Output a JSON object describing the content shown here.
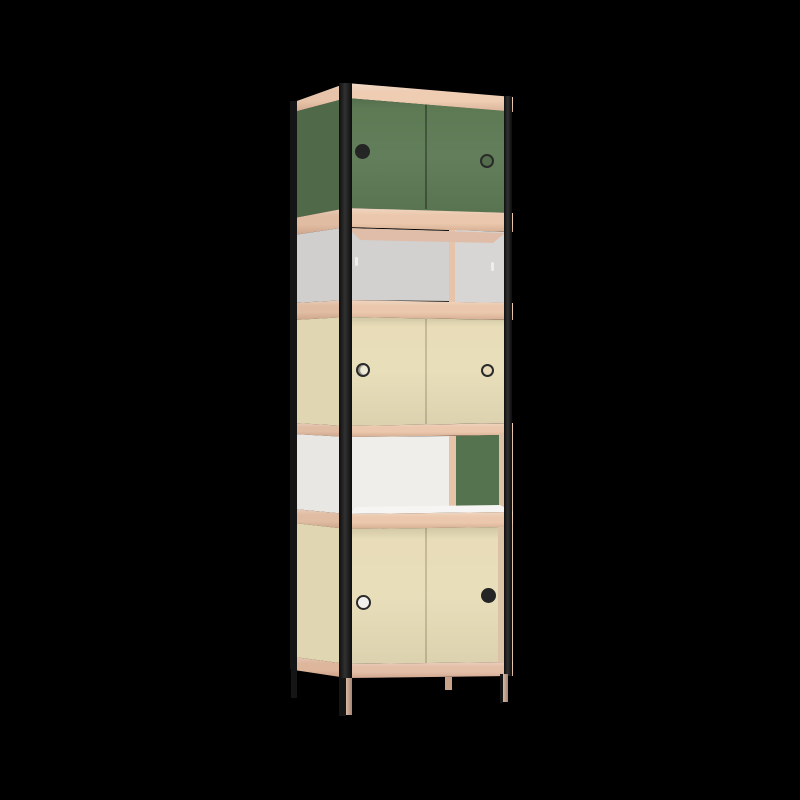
{
  "scene": {
    "background": "#000000",
    "subject": "3D product render of a five-tier modular shelving cabinet with plywood shelf edges, black frame posts and colored sliding doors"
  },
  "colors": {
    "ply_light": "#eecdb3",
    "ply_front": "#ebc8ad",
    "ply_side": "#e0bca2",
    "ply_side_top": "#e6c3a9",
    "ply_base": "#e4bfa8",
    "ply_side_base": "#ddb69c",
    "ply_ceiling": "#dfbda8",
    "ply_strip": "#e7c4a9",
    "ply_edge": "#dcc3a7",
    "green_front": "#5d7a55",
    "green_side": "#506949",
    "green_panel": "#55734e",
    "green_hole": "#4f6a48",
    "beige_front": "#e8ddb8",
    "beige_side": "#e1d6b2",
    "beige_hole": "#e5dab4",
    "beige_hole_bright": "#efe9d6",
    "gray_door_left": "#d2d1cf",
    "gray_door_right": "#d7d6d4",
    "gray_side": "#d0cfcd",
    "white_back": "#f0eeeb",
    "white_floor": "#f6f5f3",
    "white_side": "#e9e7e4",
    "hole_white": "#f3f1ee",
    "handle_light": "#eeedeb",
    "frame_black": "#151515",
    "post_black": "#1a1a1a",
    "hole_dark": "#1e1e1e",
    "hole_ring": "#242424",
    "leg_wood": "#d3ac93",
    "leg_stub": "#c9a28a",
    "seam_green": "rgba(26,36,22,0.45)",
    "seam_beige": "rgba(90,80,50,0.25)"
  },
  "cabinet": {
    "tier_count": 5,
    "tiers": [
      {
        "index": 1,
        "kind": "closed sliding doors",
        "color": "green",
        "finger_holes": [
          "solid",
          "ring"
        ]
      },
      {
        "index": 2,
        "kind": "recessed gray sliding doors",
        "color": "gray",
        "finger_holes": [
          "notch",
          "notch"
        ]
      },
      {
        "index": 3,
        "kind": "closed sliding doors",
        "color": "beige",
        "finger_holes": [
          "ring",
          "ring"
        ]
      },
      {
        "index": 4,
        "kind": "open compartment, green sliding panel pushed right",
        "color": "white / green",
        "finger_holes": []
      },
      {
        "index": 5,
        "kind": "closed sliding doors",
        "color": "beige",
        "finger_holes": [
          "ring",
          "solid"
        ]
      }
    ],
    "frame": "black posts with round finger holes",
    "shelf_edges": "exposed plywood",
    "leg_count": 4
  }
}
